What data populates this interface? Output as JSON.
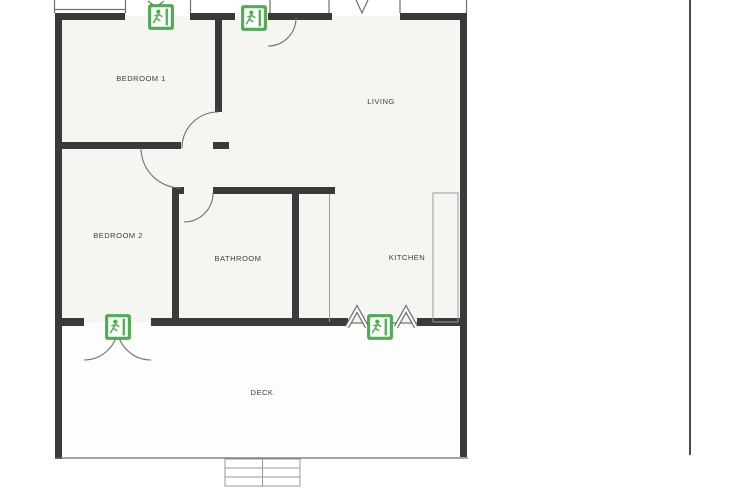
{
  "page": {
    "background": "#ffffff",
    "divider_color": "#4a4a4a"
  },
  "plan": {
    "type": "floor-plan",
    "wall_color": "#3a3a3a",
    "line_color": "#6f6f6f",
    "line_light_color": "#9a9a9a",
    "label_color": "#3f3f3f",
    "floor_fill": "#f5f5f2",
    "deck_fill": "#fdfdfc",
    "exit_green": "#4caf50",
    "exit_green_dark": "#2f8f38",
    "rooms": [
      {
        "id": "bedroom-1",
        "label": "BEDROOM 1",
        "cx": 141,
        "cy": 81
      },
      {
        "id": "living",
        "label": "LIVING",
        "cx": 381,
        "cy": 104
      },
      {
        "id": "bedroom-2",
        "label": "BEDROOM 2",
        "cx": 118,
        "cy": 238
      },
      {
        "id": "bathroom",
        "label": "BATHROOM",
        "cx": 238,
        "cy": 261
      },
      {
        "id": "kitchen",
        "label": "KITCHEN",
        "cx": 407,
        "cy": 260
      },
      {
        "id": "deck",
        "label": "DECK",
        "cx": 262,
        "cy": 395
      }
    ],
    "exit_signs": [
      {
        "id": "exit-sign-bedroom1-top",
        "cx": 161,
        "cy": 17
      },
      {
        "id": "exit-sign-living-door",
        "cx": 254,
        "cy": 18
      },
      {
        "id": "exit-sign-deck-door",
        "cx": 118,
        "cy": 327
      },
      {
        "id": "exit-sign-kitchen-window",
        "cx": 380,
        "cy": 327
      }
    ]
  }
}
